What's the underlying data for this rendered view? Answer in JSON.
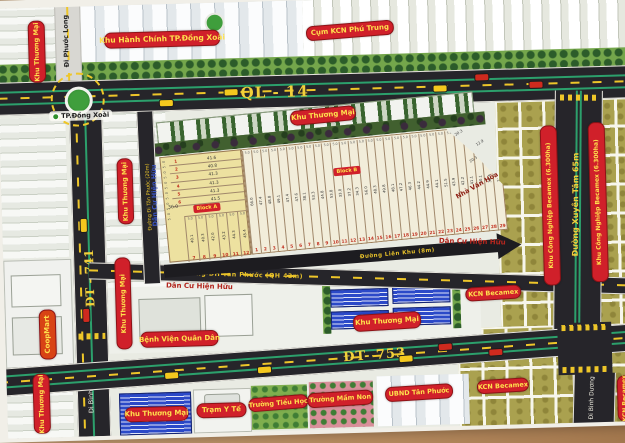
{
  "roads": {
    "ql14": "QL - 14",
    "dt741": "ĐT - 741",
    "dt753": "ĐT- 753",
    "di_phuoc_long": "Đi Phước Long",
    "di_binh_duong": "Đi Bình Dương",
    "xuyen_tam": "Đường Xuyên Tâm 65m",
    "dh_tan_phuoc": "Đường ĐH Tân Phước (QH 42m)",
    "di_tan_phuoc": "Đường Đi Tân Phước (20m)",
    "lien_khu": "Đường Liên Khu (8m)"
  },
  "landmarks": {
    "tp_dong_xoai": "TP.Đồng Xoài",
    "khu_hanh_chinh": "Khu Hành Chính TP.Đồng Xoài",
    "cum_kcn_phu_trung": "Cụm KCN Phú Trung",
    "khu_thuong_mai": "Khu Thương Mại",
    "coopmart": "CoopMart",
    "benh_vien": "Bệnh Viện Quân Dân",
    "tram_y_te": "Trạm Y Tế",
    "truong_tieu_hoc": "Trường Tiểu Học",
    "truong_mam_non": "Trường Mầm Non",
    "ubnd": "UBND Tân Phước",
    "kcn_becamex": "KCN Becamex",
    "kcn_becamex_ha": "Khu Công Nghiệp Becamex (6.300ha)",
    "nha_van_hoa": "Nhà Văn Hóa",
    "dan_cu_hien_huu": "Dân Cư Hiện Hữu"
  },
  "parcels": {
    "block_a": {
      "label": "Block A",
      "row_width": "5.0",
      "bottom_dim": "36.0",
      "rows": [
        {
          "no": "1",
          "len": "41.6"
        },
        {
          "no": "2",
          "len": "40.8"
        },
        {
          "no": "3",
          "len": "41.3"
        },
        {
          "no": "4",
          "len": "41.3"
        },
        {
          "no": "5",
          "len": "41.3"
        },
        {
          "no": "6",
          "len": "41.5"
        }
      ],
      "column_lots": [
        {
          "no": "7",
          "len": "40.1"
        },
        {
          "no": "8",
          "len": "40.3"
        },
        {
          "no": "9",
          "len": "42.0"
        },
        {
          "no": "10",
          "len": "43.2"
        },
        {
          "no": "11",
          "len": "44.3"
        },
        {
          "no": "12",
          "len": "45.4"
        }
      ]
    },
    "block_b": {
      "label": "Block B",
      "lot_width": "5.0",
      "corner_dims": [
        "20.3",
        "12.9",
        "20.3"
      ],
      "lots": [
        {
          "no": "1",
          "len": "66.0"
        },
        {
          "no": "2",
          "len": "47.4"
        },
        {
          "no": "3",
          "len": "48.8"
        },
        {
          "no": "4",
          "len": "49.1"
        },
        {
          "no": "5",
          "len": "47.4"
        },
        {
          "no": "6",
          "len": "47.6"
        },
        {
          "no": "7",
          "len": "38.1"
        },
        {
          "no": "8",
          "len": "53.3"
        },
        {
          "no": "9",
          "len": "44.8"
        },
        {
          "no": "10",
          "len": "53.8"
        },
        {
          "no": "11",
          "len": "33.0"
        },
        {
          "no": "12",
          "len": "37.2"
        },
        {
          "no": "13",
          "len": "34.3"
        },
        {
          "no": "14",
          "len": "56.0"
        },
        {
          "no": "15",
          "len": "48.3"
        },
        {
          "no": "16",
          "len": "49.8"
        },
        {
          "no": "17",
          "len": "48.1"
        },
        {
          "no": "18",
          "len": "47.2"
        },
        {
          "no": "19",
          "len": "46.3"
        },
        {
          "no": "20",
          "len": "44.2"
        },
        {
          "no": "21",
          "len": "44.9"
        },
        {
          "no": "22",
          "len": "44.1"
        },
        {
          "no": "23",
          "len": "51.5"
        },
        {
          "no": "24",
          "len": "43.9"
        },
        {
          "no": "25",
          "len": "42.2"
        },
        {
          "no": "26",
          "len": "41.1"
        },
        {
          "no": "27",
          "len": "40.1"
        },
        {
          "no": "28",
          "len": "38.4"
        },
        {
          "no": "29",
          "len": "28.4"
        }
      ]
    }
  },
  "colors": {
    "badge_red": "#d0202a",
    "badge_text": "#ffe14d",
    "road_yellow": "#eec629",
    "lane_green": "#2ca06c"
  }
}
